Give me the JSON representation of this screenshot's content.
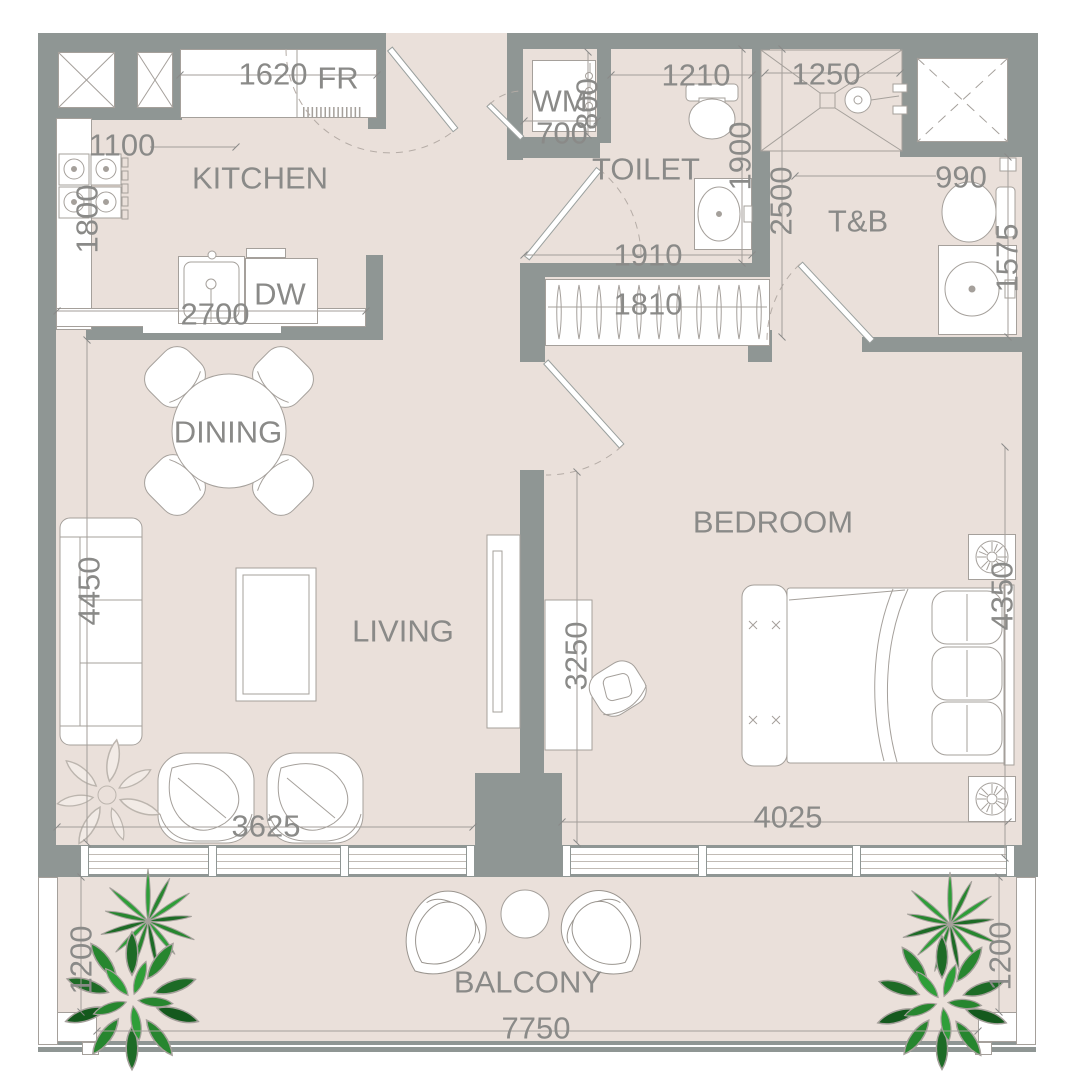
{
  "colors": {
    "floor": "#eae0da",
    "wall": "#8f9694",
    "furniture_line": "#a5a09b",
    "text": "#8a8a88",
    "plant_green": "#2e9e38",
    "plant_dark_green": "#1d6b26"
  },
  "rooms": {
    "kitchen": "KITCHEN",
    "toilet": "TOILET",
    "tnb": "T&B",
    "dining": "DINING",
    "living": "LIVING",
    "bedroom": "BEDROOM",
    "balcony": "BALCONY"
  },
  "fixtures": {
    "fridge": "FR",
    "washing_machine": "WM",
    "dishwasher": "DW"
  },
  "dims": {
    "fridge_width": "1620",
    "kitchen_opening": "1100",
    "kitchen_depth": "1800",
    "counter_run": "2700",
    "wm_width": "700",
    "wm_depth": "800",
    "toilet_width": "1210",
    "toilet_depth": "1900",
    "hall_width": "1910",
    "closet_width": "1810",
    "shower_width": "1250",
    "tnb_depth": "2500",
    "tnb_width": "990",
    "tnb_side": "1575",
    "living_depth": "4450",
    "living_width": "3625",
    "center_span": "3250",
    "bedroom_width": "4025",
    "bedroom_depth": "4350",
    "balcony_depth_left": "1200",
    "balcony_depth_right": "1200",
    "balcony_width": "7750"
  }
}
